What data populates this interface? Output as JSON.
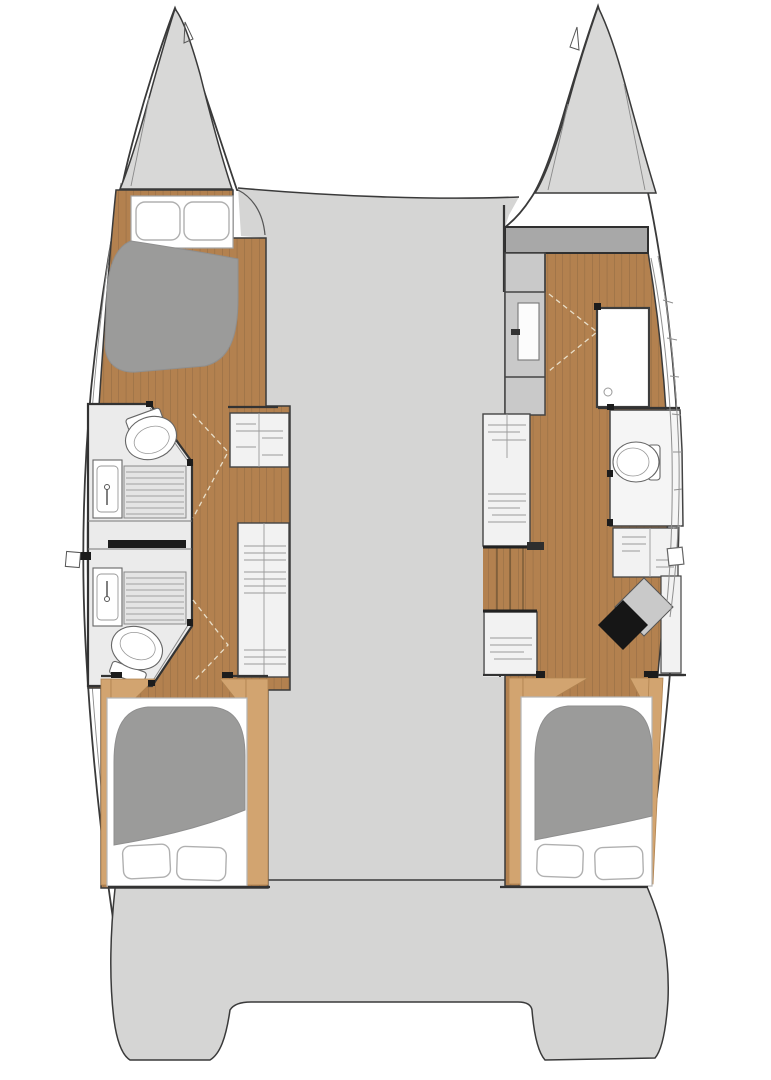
{
  "floorplan": {
    "vessel": "catamaran-yacht-layout",
    "colors": {
      "background": "#ffffff",
      "hull_white": "#ffffff",
      "outline": "#3a3a3a",
      "deck_gray": "#d5d5d4",
      "bow_gray": "#d8d8d7",
      "bulkhead_gray": "#a8a8a8",
      "niche_gray": "#c9c9c9",
      "room_gray": "#ebebeb",
      "shower_gray": "#e4e4e4",
      "cabinet_white": "#f2f2f2",
      "cabinet_line": "#9a9a9a",
      "wood": "#b3814f",
      "wood_line": "#8c6741",
      "wood_light": "#d2a470",
      "mattress_gray": "#9b9b9a",
      "seat_black": "#161616",
      "fixture_white": "#ffffff",
      "post_black": "#1c1c1c"
    },
    "port_hull": {
      "parts": [
        "bow-locker",
        "forward-double-berth",
        "forward-bathroom-toilet",
        "forward-bathroom-shower",
        "forward-bathroom-sink",
        "aft-bathroom-sink",
        "aft-bathroom-shower",
        "aft-bathroom-toilet",
        "corridor",
        "wardrobe-cabinets",
        "aft-double-berth"
      ]
    },
    "starboard_hull": {
      "parts": [
        "bow-locker",
        "dressing-area",
        "hanging-locker-door",
        "shower-cubicle",
        "toilet-compartment",
        "storage-cabinets",
        "companionway-stairs",
        "corner-desk",
        "seat",
        "aft-double-berth"
      ]
    },
    "deck": {
      "parts": [
        "foredeck",
        "center-deck",
        "transom-platform"
      ]
    }
  }
}
